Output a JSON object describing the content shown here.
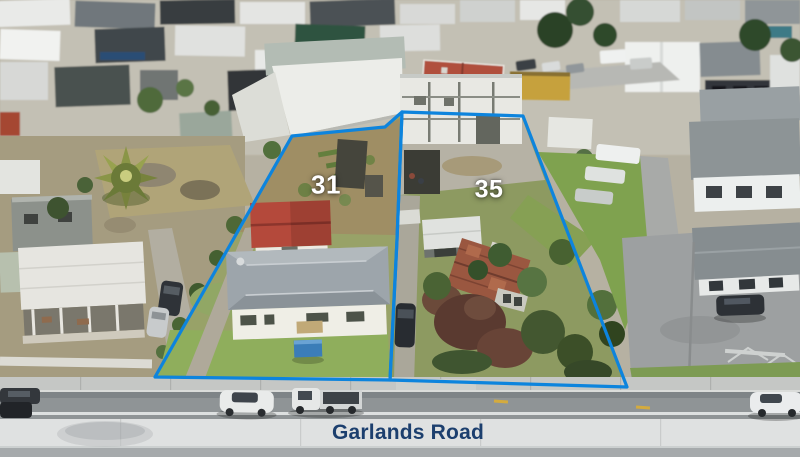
{
  "scene": {
    "road_label": "Garlands Road",
    "lots": [
      {
        "number": "31"
      },
      {
        "number": "35"
      }
    ],
    "colors": {
      "boundary_blue": "#0d84dd",
      "lot_label_white": "#ffffff",
      "road_label_navy": "#1c3f6e"
    }
  }
}
